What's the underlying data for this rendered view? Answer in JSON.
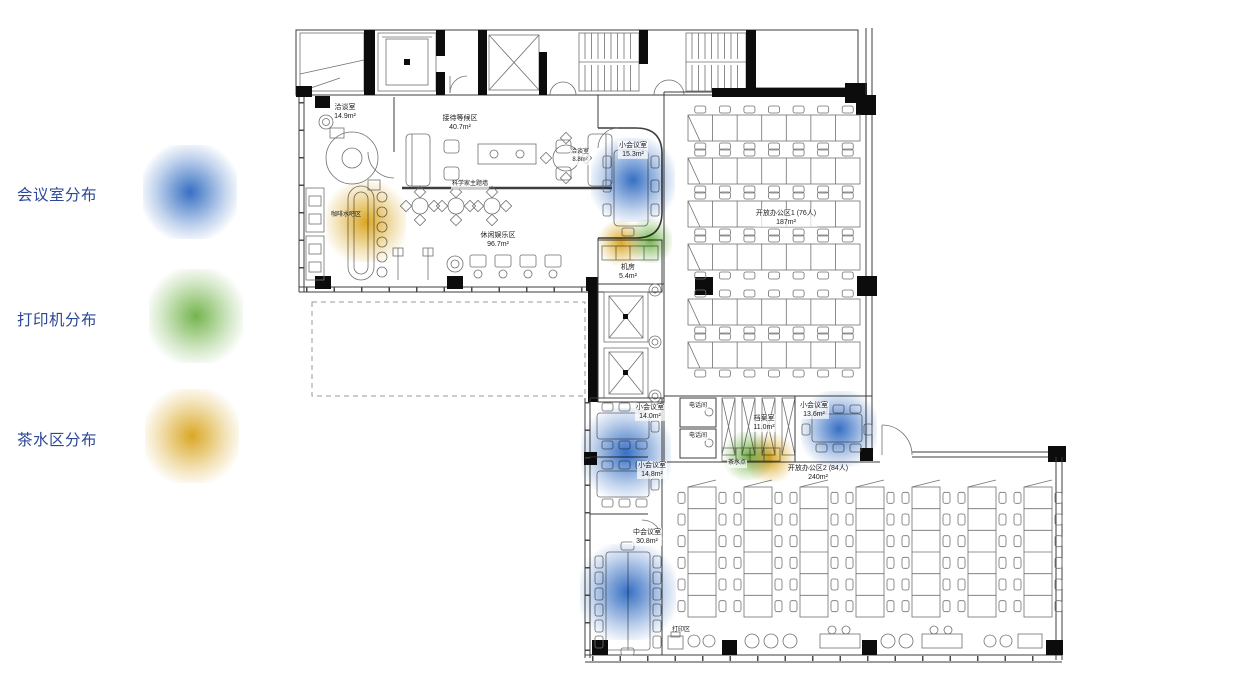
{
  "legend": {
    "text_color": "#2b4796",
    "items": [
      {
        "id": "meeting",
        "label": "会议室分布",
        "color": "#2563be"
      },
      {
        "id": "printer",
        "label": "打印机分布",
        "color": "#69ae3f"
      },
      {
        "id": "tea",
        "label": "茶水区分布",
        "color": "#d7a012"
      }
    ]
  },
  "plan": {
    "rooms": [
      {
        "name": "洽谈室",
        "area": "14.9m²",
        "x": 345,
        "y": 112,
        "bg": true
      },
      {
        "name": "接待等候区",
        "area": "40.7m²",
        "x": 460,
        "y": 123,
        "bg": true
      },
      {
        "name": "科学家主题墙",
        "x": 470,
        "y": 185,
        "small": true,
        "bg": true
      },
      {
        "name": "休闲娱乐区",
        "area": "96.7m²",
        "x": 498,
        "y": 240,
        "bg": true
      },
      {
        "name": "洽谈室",
        "area": "8.8m²",
        "x": 580,
        "y": 157,
        "small": true,
        "bg": true
      },
      {
        "name": "咖啡水吧区",
        "x": 346,
        "y": 216,
        "small": true
      },
      {
        "name": "小会议室",
        "area": "15.3m²",
        "x": 633,
        "y": 150,
        "bg": true
      },
      {
        "name": "机房",
        "area": "5.4m²",
        "x": 628,
        "y": 272,
        "bg": true
      },
      {
        "name": "开放办公区1 (76人)",
        "area": "187m²",
        "x": 786,
        "y": 218,
        "bg": true
      },
      {
        "name": "电话间",
        "x": 698,
        "y": 407,
        "small": true,
        "bg": true
      },
      {
        "name": "电话间",
        "x": 698,
        "y": 437,
        "small": true,
        "bg": true
      },
      {
        "name": "档案室",
        "area": "11.0m²",
        "x": 764,
        "y": 423,
        "bg": true
      },
      {
        "name": "小会议室",
        "area": "13.6m²",
        "x": 814,
        "y": 410,
        "bg": true
      },
      {
        "name": "茶水点",
        "x": 737,
        "y": 464,
        "small": true,
        "bg": true
      },
      {
        "name": "开放办公区2 (84人)",
        "area": "240m²",
        "x": 818,
        "y": 473
      },
      {
        "name": "小会议室",
        "area": "14.0m²",
        "x": 650,
        "y": 412,
        "bg": true
      },
      {
        "name": "小会议室",
        "area": "14.8m²",
        "x": 652,
        "y": 470,
        "bg": true
      },
      {
        "name": "中会议室",
        "area": "30.8m²",
        "x": 647,
        "y": 537,
        "bg": true
      },
      {
        "name": "打印区",
        "x": 681,
        "y": 631,
        "small": true
      }
    ],
    "heat_points": [
      {
        "type": "meeting",
        "x": 633,
        "y": 180,
        "r": 42
      },
      {
        "type": "tea",
        "x": 366,
        "y": 222,
        "r": 40
      },
      {
        "type": "tea",
        "x": 621,
        "y": 243,
        "r": 22
      },
      {
        "type": "printer",
        "x": 650,
        "y": 241,
        "r": 22
      },
      {
        "type": "meeting",
        "x": 626,
        "y": 453,
        "r": 45
      },
      {
        "type": "meeting",
        "x": 839,
        "y": 429,
        "r": 38
      },
      {
        "type": "printer",
        "x": 748,
        "y": 456,
        "r": 24
      },
      {
        "type": "tea",
        "x": 770,
        "y": 458,
        "r": 24
      },
      {
        "type": "meeting",
        "x": 628,
        "y": 592,
        "r": 48
      }
    ]
  }
}
